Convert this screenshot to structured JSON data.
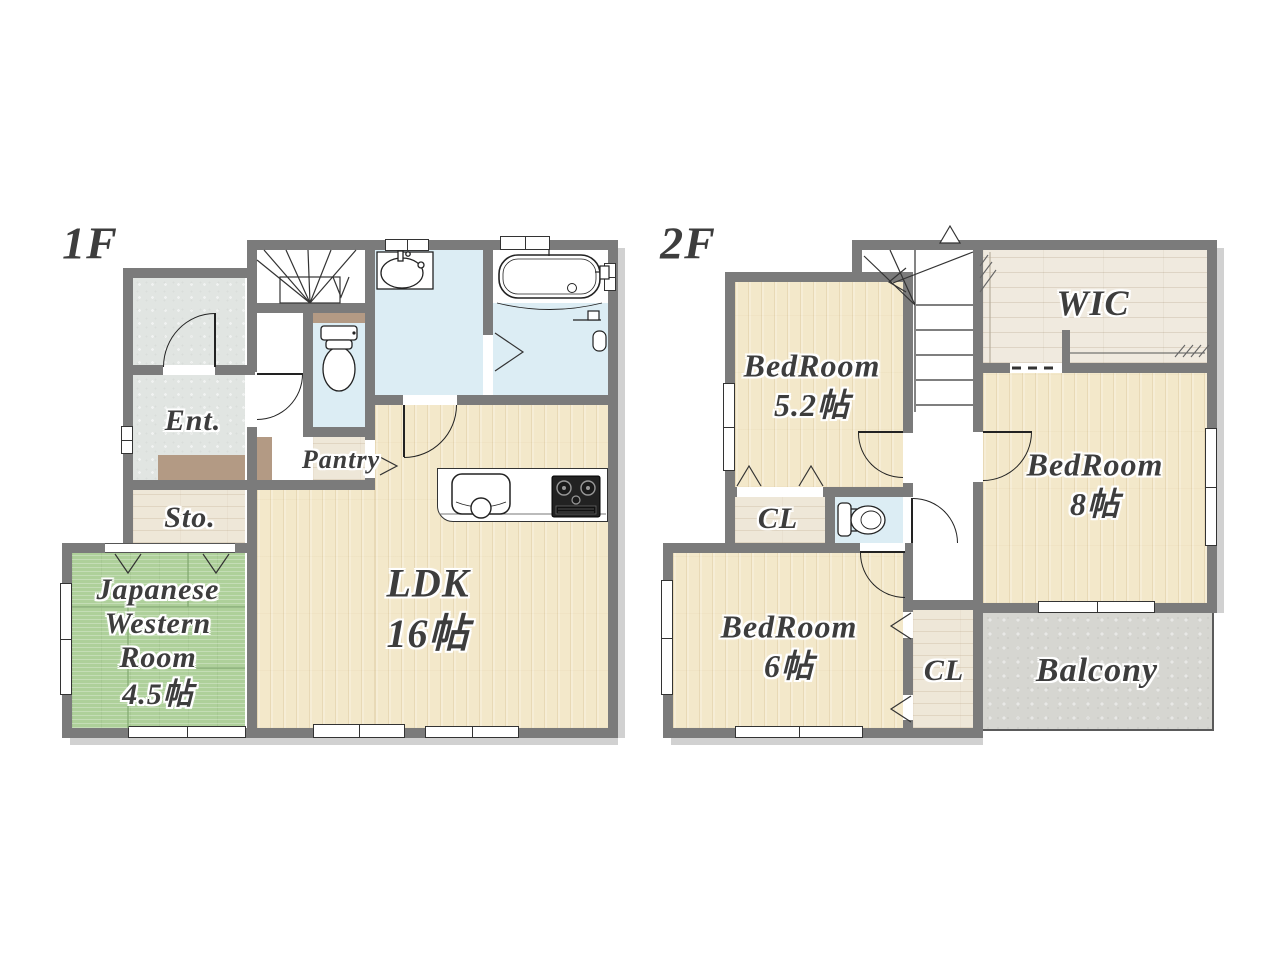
{
  "plan_type": "residential-floor-plan",
  "floors": {
    "f1": {
      "label": "1F",
      "rooms": {
        "entrance": {
          "label": "Ent."
        },
        "storage": {
          "label": "Sto."
        },
        "japanese_western_room": {
          "line1": "Japanese",
          "line2": "Western",
          "line3": "Room",
          "line4": "4.5帖"
        },
        "pantry": {
          "label": "Pantry"
        },
        "ldk": {
          "line1": "LDK",
          "line2": "16帖"
        }
      }
    },
    "f2": {
      "label": "2F",
      "rooms": {
        "bedroom_5_2": {
          "line1": "BedRoom",
          "line2": "5.2帖"
        },
        "wic": {
          "label": "WIC"
        },
        "bedroom_8": {
          "line1": "BedRoom",
          "line2": "8帖"
        },
        "closet_a": {
          "label": "CL"
        },
        "closet_b": {
          "label": "CL"
        },
        "bedroom_6": {
          "line1": "BedRoom",
          "line2": "6帖"
        },
        "balcony": {
          "label": "Balcony"
        }
      }
    }
  },
  "colors": {
    "wall": "#7b7b7b",
    "wood_floor": "#f3e8ca",
    "closet_floor": "#eee7d8",
    "tatami": "#aed09a",
    "water_room": "#dcedf4",
    "concrete": "#e1e5e2",
    "balcony": "#d6d6d1",
    "accent_brown": "#b39a84",
    "label_text": "#3d3d3d"
  }
}
